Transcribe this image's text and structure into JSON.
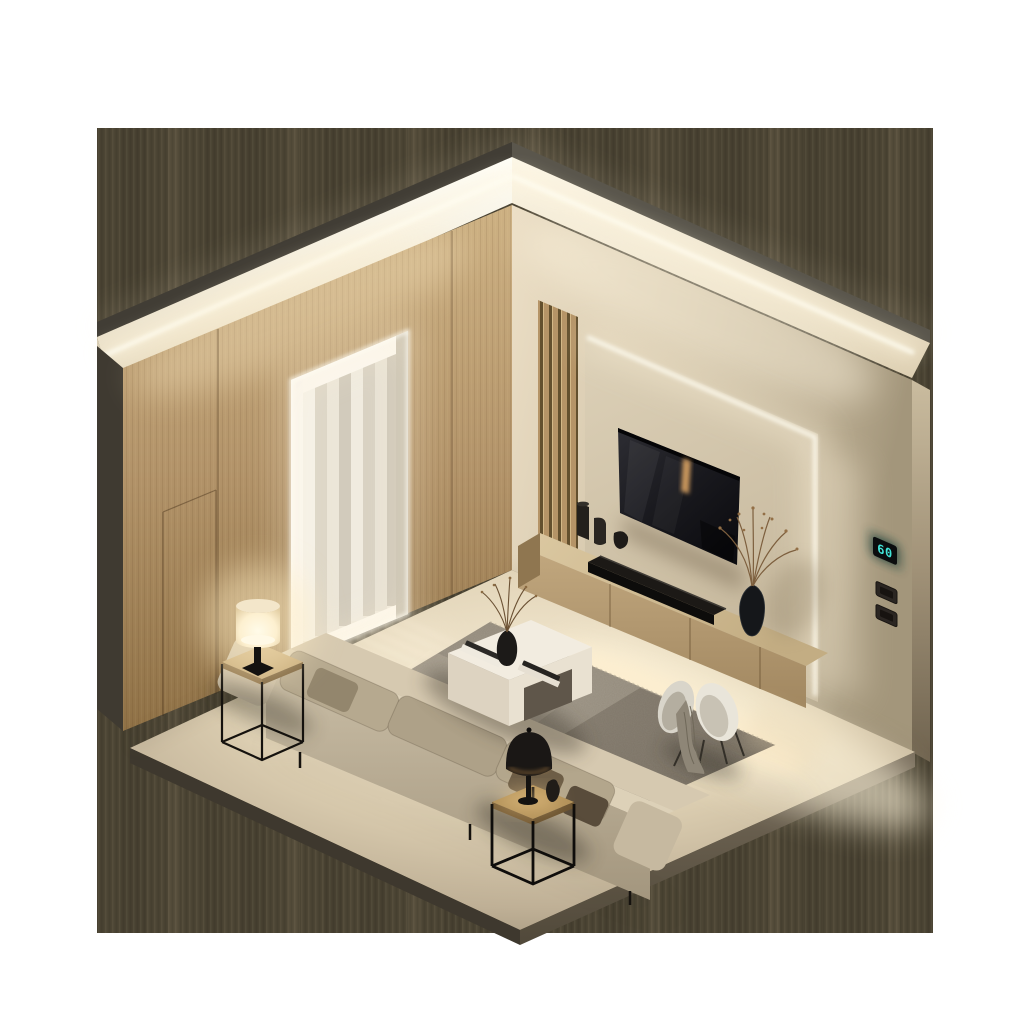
{
  "meta": {
    "description": "Isometric 3D render of a minimalist living room with warm LED cove lighting, wood panel wall, backlit TV wall, sofa, coffee table and accent chair",
    "render_style": "isometric cutaway, warm dusk lighting"
  },
  "controls": {
    "thermostat_value": "60",
    "thermostat_color": "#41e4d8"
  },
  "palette": {
    "backdrop": "#4c4534",
    "wood_wall": "#b3946a",
    "accent_wall": "#d3c5aa",
    "floor": "#ddcfb2",
    "led_glow": "#fff6de",
    "rug": "#8d8475",
    "sofa": "#c0b39b",
    "tv_screen": "#17171b",
    "metal_black": "#15120e"
  },
  "objects": [
    {
      "name": "led-cove-ceiling",
      "label": "Ceiling LED cove strips"
    },
    {
      "name": "wood-panel-wall",
      "label": "Oak panel wall with hidden door"
    },
    {
      "name": "doorway",
      "label": "LED-framed doorway with sheer curtains"
    },
    {
      "name": "accent-wall",
      "label": "Beige accent wall with backlit TV panel"
    },
    {
      "name": "slat-panel",
      "label": "Vertical wood slat feature"
    },
    {
      "name": "tv",
      "label": "Wall-mounted television"
    },
    {
      "name": "soundbar",
      "label": "Black soundbar"
    },
    {
      "name": "media-console",
      "label": "Floating oak media console"
    },
    {
      "name": "thermostat",
      "label": "Wall thermostat display"
    },
    {
      "name": "light-switches",
      "label": "Two rocker light switches"
    },
    {
      "name": "sofa",
      "label": "Beige three-seat fabric sofa with cushions"
    },
    {
      "name": "coffee-table",
      "label": "White coffee table with books and vase"
    },
    {
      "name": "side-table-left",
      "label": "Metal-frame side table with white drum lamp"
    },
    {
      "name": "side-table-front",
      "label": "Cube side table with black dome lamp"
    },
    {
      "name": "rug",
      "label": "Grey textured area rug"
    },
    {
      "name": "accent-chair",
      "label": "White shell chair with throw blanket"
    },
    {
      "name": "dried-branches",
      "label": "Vases with dried branches"
    }
  ]
}
